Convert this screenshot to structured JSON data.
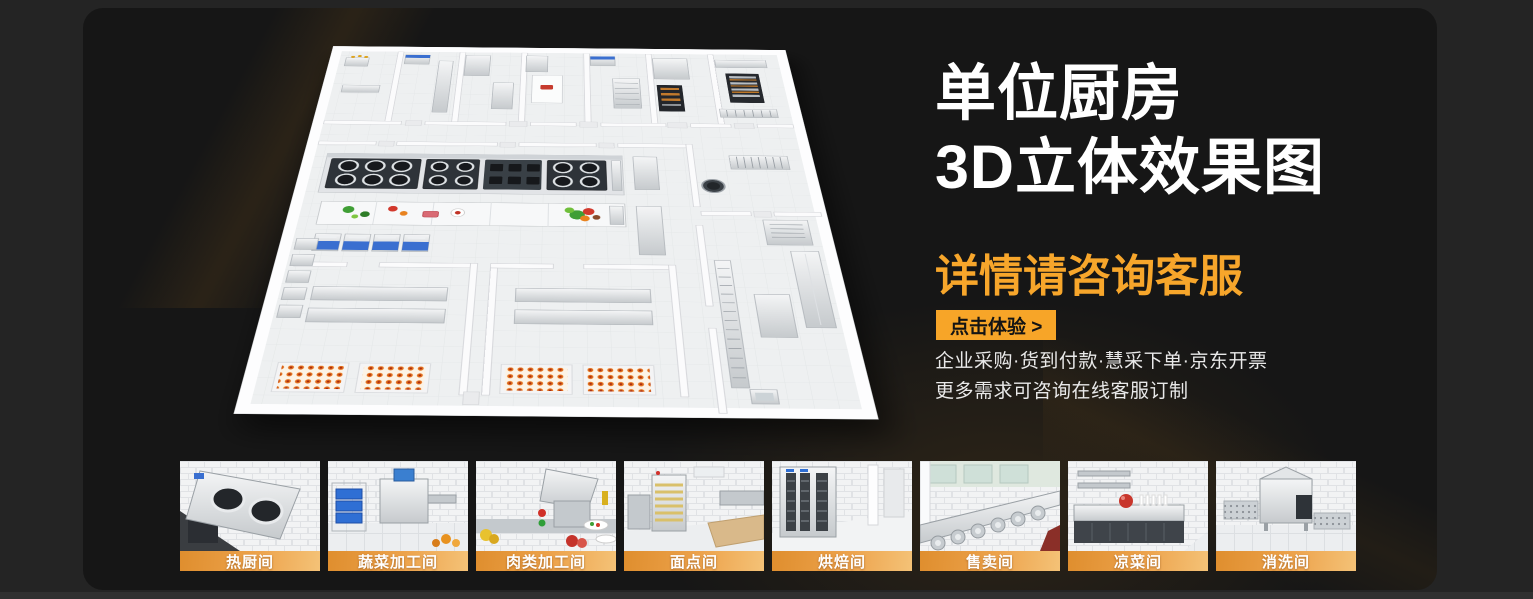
{
  "hero": {
    "title_line1": "单位厨房",
    "title_line2": "3D立体效果图",
    "subtitle": "详情请咨询客服",
    "cta_label": "点击体验 >",
    "feature_line1": "企业采购·货到付款·慧采下单·京东开票",
    "feature_line2": "更多需求可咨询在线客服订制"
  },
  "colors": {
    "accent_orange": "#F7A528",
    "subtitle_orange": "#F7A62B",
    "label_band_orange": "#EDA34C",
    "card_bg": "#161616",
    "page_bg": "#242424"
  },
  "thumbnails": [
    {
      "label": "热厨间"
    },
    {
      "label": "蔬菜加工间"
    },
    {
      "label": "肉类加工间"
    },
    {
      "label": "面点间"
    },
    {
      "label": "烘焙间"
    },
    {
      "label": "售卖间"
    },
    {
      "label": "凉菜间"
    },
    {
      "label": "消洗间"
    }
  ]
}
